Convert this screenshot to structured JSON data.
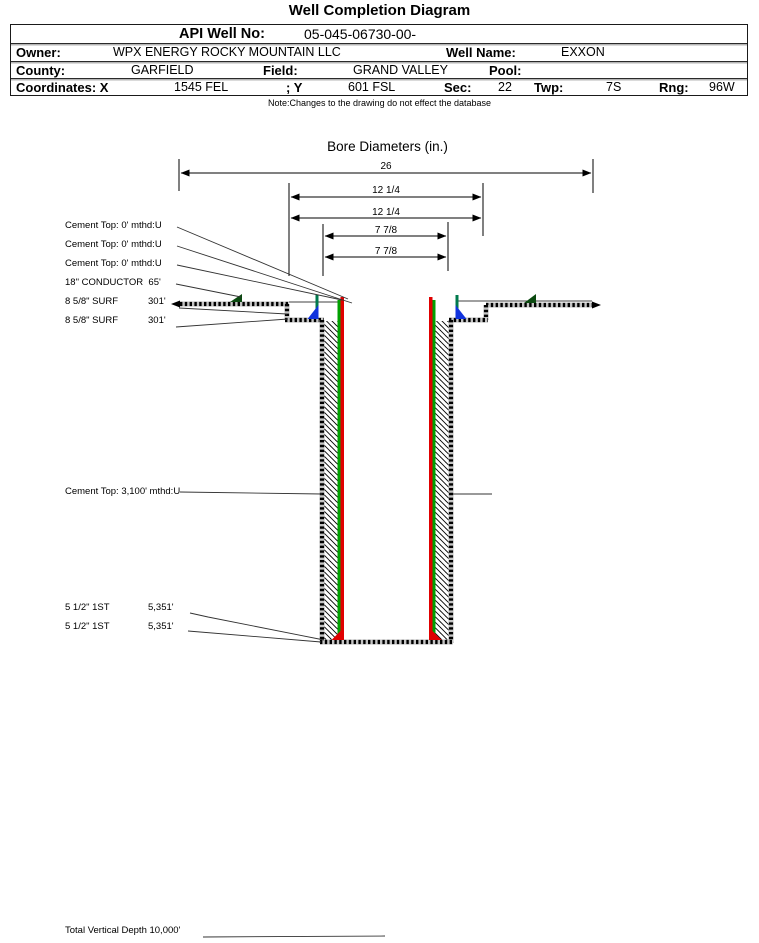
{
  "title": "Well Completion Diagram",
  "header": {
    "api_label": "API Well No:",
    "api_value": "05-045-06730-00-",
    "owner_label": "Owner:",
    "owner_value": "WPX ENERGY ROCKY MOUNTAIN LLC",
    "well_name_label": "Well Name:",
    "well_name_value": "EXXON",
    "county_label": "County:",
    "county_value": "GARFIELD",
    "field_label": "Field:",
    "field_value": "GRAND VALLEY",
    "pool_label": "Pool:",
    "pool_value": "",
    "coords_label": "Coordinates: X",
    "coords_x_value": "1545 FEL",
    "coords_y_label": "; Y",
    "coords_y_value": "601 FSL",
    "sec_label": "Sec:",
    "sec_value": "22",
    "twp_label": "Twp:",
    "twp_value": "7S",
    "rng_label": "Rng:",
    "rng_value": "96W"
  },
  "note": "Note:Changes to the drawing do not effect the database",
  "diagram": {
    "section_title": "Bore Diameters (in.)",
    "dimensions": [
      {
        "label": "26"
      },
      {
        "label": "12 1/4"
      },
      {
        "label": "12 1/4"
      },
      {
        "label": "7 7/8"
      },
      {
        "label": "7 7/8"
      }
    ],
    "annotations": {
      "cement_top_1": "Cement Top: 0' mthd:U",
      "cement_top_2": "Cement Top: 0' mthd:U",
      "cement_top_3": "Cement Top: 0' mthd:U",
      "conductor": "18\" CONDUCTOR  65'",
      "surf_1_name": "8 5/8\" SURF",
      "surf_1_depth": "301'",
      "surf_2_name": "8 5/8\" SURF",
      "surf_2_depth": "301'",
      "cement_top_mid": "Cement Top: 3,100' mthd:U",
      "prod_1_name": "5 1/2\" 1ST",
      "prod_1_depth": "5,351'",
      "prod_2_name": "5 1/2\" 1ST",
      "prod_2_depth": "5,351'",
      "tvd": "Total Vertical Depth 10,000'"
    },
    "colors": {
      "casing": "#e00000",
      "cement_stripe": "#00a000",
      "surface_casing": "#007a4d",
      "cement_marker": "#1133dd",
      "surface_marker": "#0b4a10"
    }
  }
}
